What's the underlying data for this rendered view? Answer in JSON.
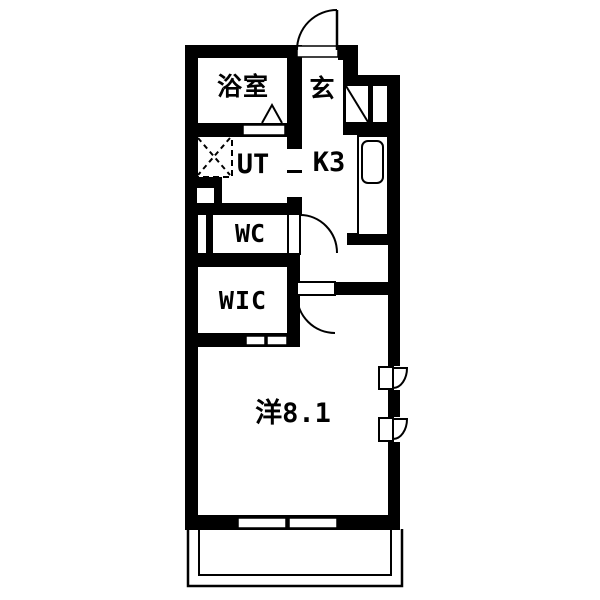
{
  "floorplan": {
    "rooms": {
      "bathroom": {
        "label": "浴室"
      },
      "entrance": {
        "label": "玄"
      },
      "utility": {
        "label": "UT"
      },
      "kitchen": {
        "label": "K3"
      },
      "toilet": {
        "label": "WC"
      },
      "closet": {
        "label": "WIC"
      },
      "main_room": {
        "label": "洋8.1"
      }
    },
    "colors": {
      "wall": "#000000",
      "floor": "#ffffff"
    }
  }
}
